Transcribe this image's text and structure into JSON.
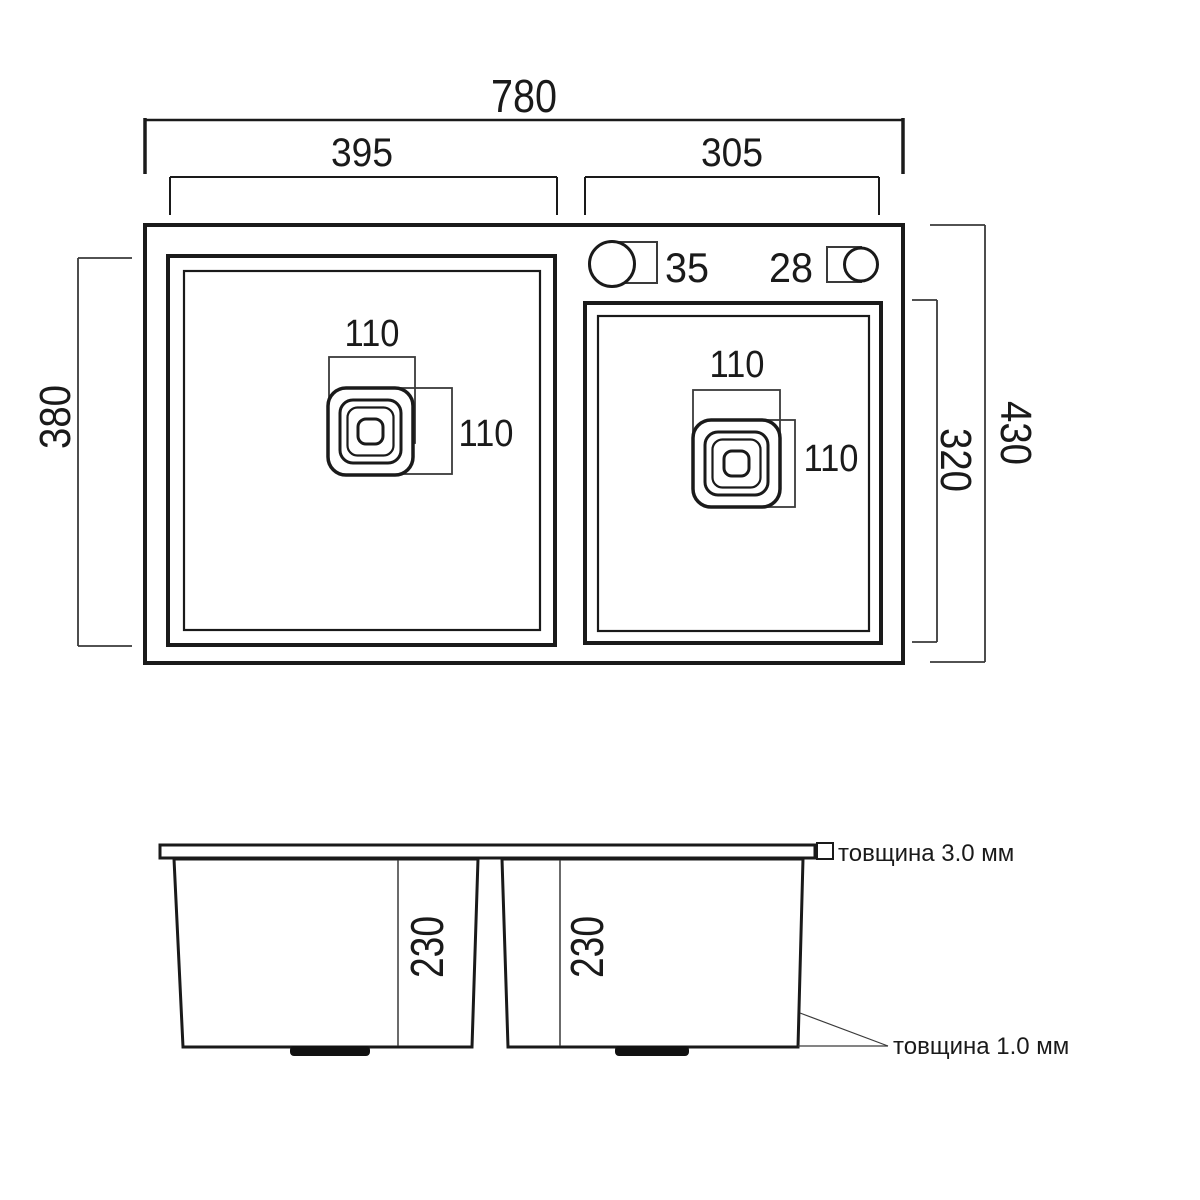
{
  "top_view": {
    "overall_width": "780",
    "left_bowl_width": "395",
    "right_bowl_width": "305",
    "left_bowl_depth": "380",
    "overall_depth": "430",
    "right_bowl_depth": "320",
    "faucet_hole": "35",
    "extra_hole": "28",
    "left_drain_width": "110",
    "left_drain_height": "110",
    "right_drain_width": "110",
    "right_drain_height": "110"
  },
  "side_view": {
    "left_bowl_depth": "230",
    "right_bowl_depth": "230",
    "rim_thickness_label": "товщина 3.0 мм",
    "wall_thickness_label": "товщина 1.0 мм"
  },
  "colors": {
    "line": "#1a1a1a",
    "background": "#ffffff"
  }
}
